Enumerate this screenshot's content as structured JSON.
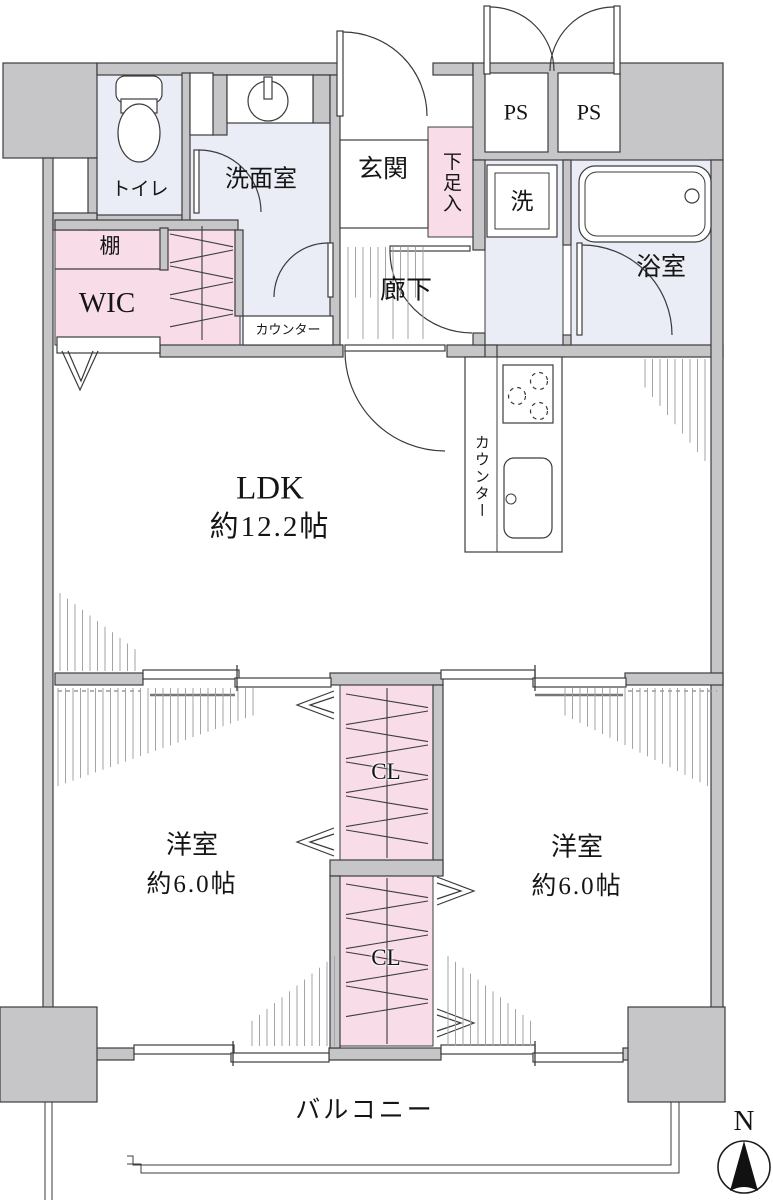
{
  "floor_plan": {
    "labels": {
      "toilet": "トイレ",
      "washroom": "洗面室",
      "entrance": "玄関",
      "shoe_cabinet": "下足入",
      "pipe_shaft_1": "PS",
      "pipe_shaft_2": "PS",
      "washer": "洗",
      "bathroom": "浴室",
      "shelf": "棚",
      "walk_in_closet": "WIC",
      "counter": "カウンター",
      "corridor": "廊下",
      "ldk": "LDK",
      "ldk_size": "約12.2帖",
      "kitchen_counter": "カウンター",
      "closet_1": "CL",
      "closet_2": "CL",
      "bedroom_1": "洋室",
      "bedroom_1_size": "約6.0帖",
      "bedroom_2": "洋室",
      "bedroom_2_size": "約6.0帖",
      "balcony": "バルコニー",
      "compass_north": "N"
    },
    "colors": {
      "wall": "#c6c6c8",
      "closet_pink": "#f8dce8",
      "wet_area_blue": "#eaedf6",
      "line": "#3c3c3e",
      "hatch": "#a3a3a8"
    }
  }
}
